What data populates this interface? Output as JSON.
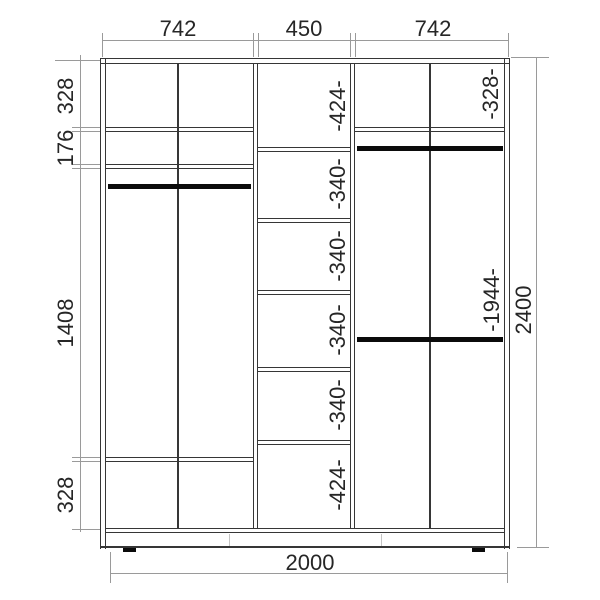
{
  "meta": {
    "type": "wardrobe-dimension-drawing",
    "units": "mm"
  },
  "dims": {
    "top": [
      {
        "label": "742"
      },
      {
        "label": "450"
      },
      {
        "label": "742"
      }
    ],
    "left": [
      {
        "label": "328"
      },
      {
        "label": "176"
      },
      {
        "label": "1408"
      },
      {
        "label": "328"
      }
    ],
    "bottom": {
      "label": "2000"
    },
    "right": {
      "label": "2400"
    },
    "middle_column": [
      {
        "label": "-424-"
      },
      {
        "label": "-340-"
      },
      {
        "label": "-340-"
      },
      {
        "label": "-340-"
      },
      {
        "label": "-340-"
      },
      {
        "label": "-424-"
      }
    ],
    "right_section": [
      {
        "label": "-328-"
      },
      {
        "label": "-1944-"
      }
    ]
  },
  "colors": {
    "line": "#363636",
    "dim_line": "#9a9a9a",
    "rod": "#0b0b0b",
    "text": "#262626",
    "background": "#ffffff"
  }
}
